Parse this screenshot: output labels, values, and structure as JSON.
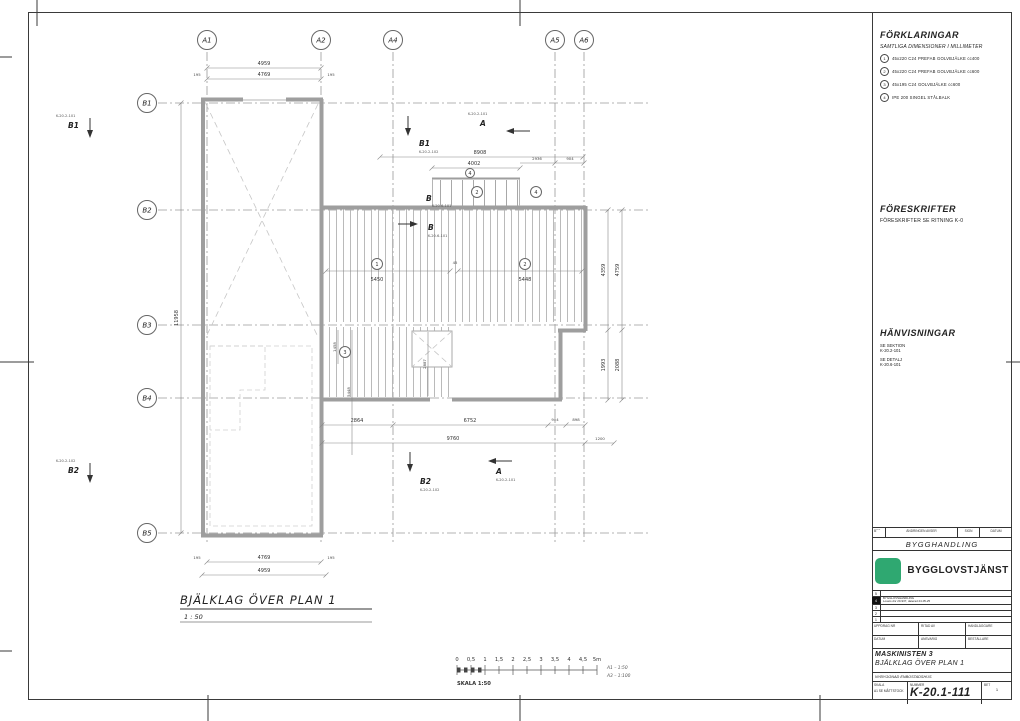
{
  "plan": {
    "title": "BJÄLKLAG ÖVER PLAN 1",
    "scale": "1 : 50",
    "grid_cols": [
      "A1",
      "A2",
      "A4",
      "A5",
      "A6"
    ],
    "grid_rows": [
      "B1",
      "B2",
      "B3",
      "B4",
      "B5"
    ],
    "markers": {
      "b1": "B1",
      "b2": "B2",
      "a": "A",
      "b": "B",
      "ref_section_a": "K-20.2-101",
      "ref_section_b": "K-20.2-102",
      "ref_detail": "K-20.6-101"
    },
    "circles": {
      "c1": "1",
      "c2": "2",
      "c3": "3",
      "c4": "4"
    },
    "dims": {
      "a1a2_outer": "4959",
      "a1a2_inner": "4769",
      "side195": "195",
      "top_long": "8908",
      "strip": "4002",
      "d2936": "2936",
      "d904": "904",
      "j1": "5450",
      "j2": "5448",
      "gap45": "45",
      "b2864": "2864",
      "b6752": "6752",
      "b904": "904",
      "b898": "898",
      "c9760": "9760",
      "c1200": "1200",
      "r_in1": "4359",
      "r_in2": "1993",
      "r_out1": "4759",
      "r_out2": "2088",
      "left_total": "11958",
      "v1458": "1458",
      "v5448": "5448",
      "v2887": "2887"
    }
  },
  "scalebar": {
    "ticks": [
      "0",
      "0,5",
      "1",
      "1,5",
      "2",
      "2,5",
      "3",
      "3,5",
      "4",
      "4,5",
      "5m"
    ],
    "label": "SKALA 1:50",
    "a1": "A1 – 1:50",
    "a3": "A3 – 1:100"
  },
  "panel": {
    "legend": {
      "title": "FÖRKLARINGAR",
      "subtitle": "SAMTLIGA DIMENSIONER I MILLIMETER",
      "items": [
        {
          "num": "1",
          "text": "45x220 C24 PREFAB GOLVBJÄLKE cc400"
        },
        {
          "num": "2",
          "text": "45x220 C24 PREFAB GOLVBJÄLKE cc600"
        },
        {
          "num": "3",
          "text": "45x195 C24 GOLVBJÄLKE cc600"
        },
        {
          "num": "4",
          "text": "IPE 200 SINGEL STÅLBALK"
        }
      ]
    },
    "regulations": {
      "title": "FÖRESKRIFTER",
      "text": "FÖRESKRIFTER SE RITNING K-0"
    },
    "references": {
      "title": "HÄNVISNINGAR",
      "items": [
        {
          "label": "SE SEKTION",
          "ref": "K-20.2-101"
        },
        {
          "label": "SE DETALJ",
          "ref": "K-20.6-101"
        }
      ]
    }
  },
  "titleblock": {
    "rev_header": [
      "BET",
      "ÄNDRINGEN AVSER",
      "SIGN",
      "DATUM"
    ],
    "status": "BYGGHANDLING",
    "company": "BYGGLOVSTJÄNST",
    "brand_color": "#2fa871",
    "rev_rows": [
      "5",
      "4",
      "3",
      "2",
      "1"
    ],
    "rev_note1": "BYGGLOVSHANDLING",
    "rev_note2": "Lovets dnr 20-937, daterad 24-05-25",
    "fields_row1": [
      "UPPDRAG NR",
      "RITAD AV",
      "HANDLÄGGARE"
    ],
    "fields_row2": [
      "DATUM",
      "ANSVARIG",
      "BESTÄLLARE"
    ],
    "project1": "MASKINISTEN 3",
    "project2": "BJÄLKLAG ÖVER PLAN 1",
    "project3": "NYBYGGNAD ENBOSTADSHUS",
    "scale_label": "SKALA",
    "scale_value": "A1 SE MÅTTSTOCK",
    "number_label": "NUMMER",
    "number": "K-20.1-111",
    "bet_label": "BET",
    "bet_value": "1"
  }
}
